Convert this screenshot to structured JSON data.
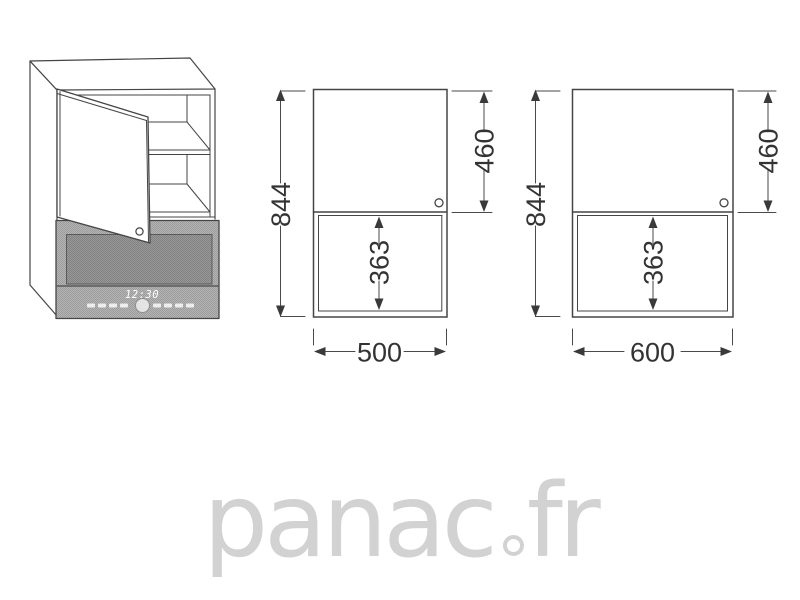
{
  "page": {
    "background": "#ffffff"
  },
  "drawing": {
    "line_color": "#454545",
    "dim_color": "#333333",
    "subject": "wall cabinet with open door over microwave niche"
  },
  "cabinet_3d": {
    "microwave": {
      "clock": "12:30"
    }
  },
  "front_views": [
    {
      "id": "front-view-500",
      "total_height": "844",
      "door_height": "460",
      "niche_height": "363",
      "width": "500"
    },
    {
      "id": "front-view-600",
      "total_height": "844",
      "door_height": "460",
      "niche_height": "363",
      "width": "600"
    }
  ],
  "watermark": {
    "text": "panac.fr",
    "part_before_dot": "panac",
    "part_after_dot": "fr",
    "color": "#d2d2d2"
  }
}
